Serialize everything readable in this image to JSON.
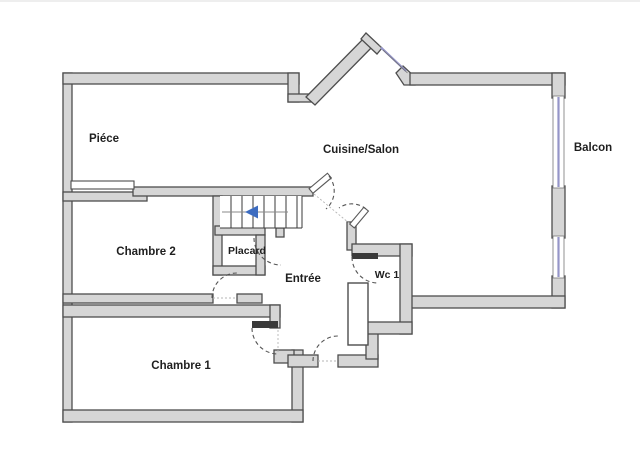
{
  "page": {
    "type": "floor-plan",
    "background": "#ffffff"
  },
  "colors": {
    "wall_fill": "#d6d6d6",
    "wall_stroke": "#4d4d4d",
    "window": "#9595c8",
    "door_arc": "#555555",
    "stair_arrow": "#3d6cc0",
    "label": "#1f1f1f",
    "page_bg": "#ffffff"
  },
  "rooms": [
    {
      "label": "Piéce"
    },
    {
      "label": "Cuisine/Salon"
    },
    {
      "label": "Balcon"
    },
    {
      "label": "Chambre 2"
    },
    {
      "label": "Placard"
    },
    {
      "label": "Entrée"
    },
    {
      "label": "Wc 1"
    },
    {
      "label": "Chambre 1"
    }
  ],
  "stairs": {
    "steps": 7,
    "direction_arrow": "left"
  },
  "windows": [
    {
      "location": "right-wall-upper"
    },
    {
      "location": "right-wall-lower"
    },
    {
      "location": "top-diagonal"
    }
  ]
}
